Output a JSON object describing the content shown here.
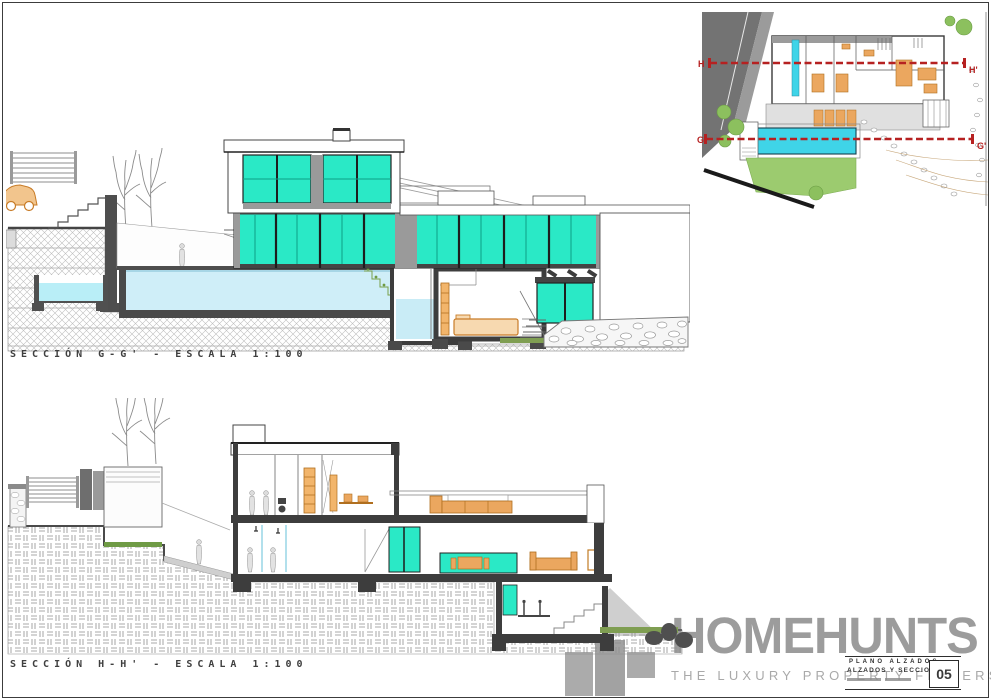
{
  "sheet": {
    "width": 991,
    "height": 699,
    "sections": [
      {
        "label": "SECCIÓN G-G' - ESCALA 1:100"
      },
      {
        "label": "SECCIÓN H-H' - ESCALA 1:100"
      }
    ]
  },
  "site_plan": {
    "markers": {
      "h_start": "H",
      "h_end": "H'",
      "g_start": "G",
      "g_end": "G'"
    }
  },
  "logo": {
    "brand": "HOMEHUNTS",
    "tagline": "THE LUXURY PROPERTY FINDERS"
  },
  "title_block": {
    "line1": "PLANO ALZADOS",
    "line2": "ALZADOS Y SECCIONES",
    "sheet_number": "05"
  },
  "colors": {
    "glass_teal": "#2ae9c6",
    "pool_water": "#cfeef8",
    "plan_pool_cyan": "#3fd4e8",
    "section_line_red": "#b62121",
    "furniture_orange": "#eba75f",
    "lawn_green": "#9ccb6f",
    "cut_wall_gray": "#3d3d3d",
    "logo_gray": "#9c9c9c"
  }
}
